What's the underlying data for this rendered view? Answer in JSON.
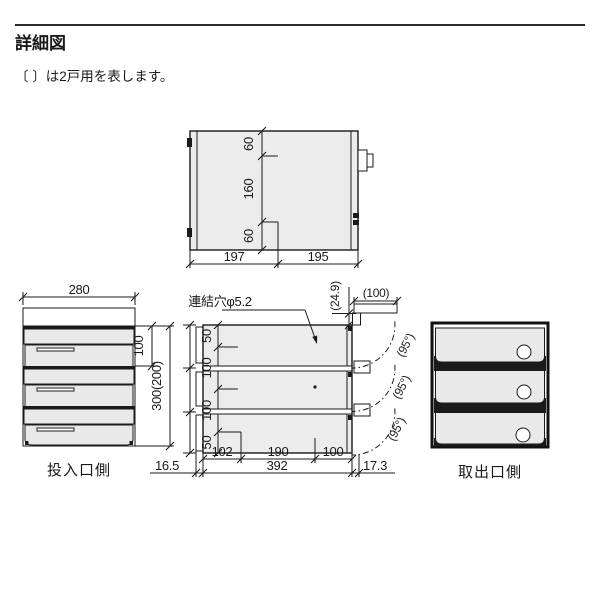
{
  "page": {
    "title": "詳細図",
    "note": "〔 〕は2戸用を表します。"
  },
  "colors": {
    "line": "#1a1a1a",
    "panel_fill": "#ececec",
    "background": "#ffffff"
  },
  "top_view": {
    "width_segments": [
      "60",
      "160",
      "60"
    ],
    "depth_segments": [
      "197",
      "195"
    ]
  },
  "front_view": {
    "width": "280",
    "unit_height": "100",
    "total_height": "300(200)",
    "label": "投入口側",
    "front_clearance": "16.5"
  },
  "side_view": {
    "hole_note": "連結穴φ5.2",
    "height_segments": [
      "50",
      "100",
      "100",
      "50"
    ],
    "depth_segments": [
      "102",
      "190",
      "100"
    ],
    "depth_total": "392",
    "rear_clearance": "17.3",
    "door_rise": "(24.9)",
    "door_depth": "(100)",
    "door_angles": [
      "(95°)",
      "(95°)",
      "(95°)"
    ]
  },
  "rear_view": {
    "label": "取出口側"
  }
}
